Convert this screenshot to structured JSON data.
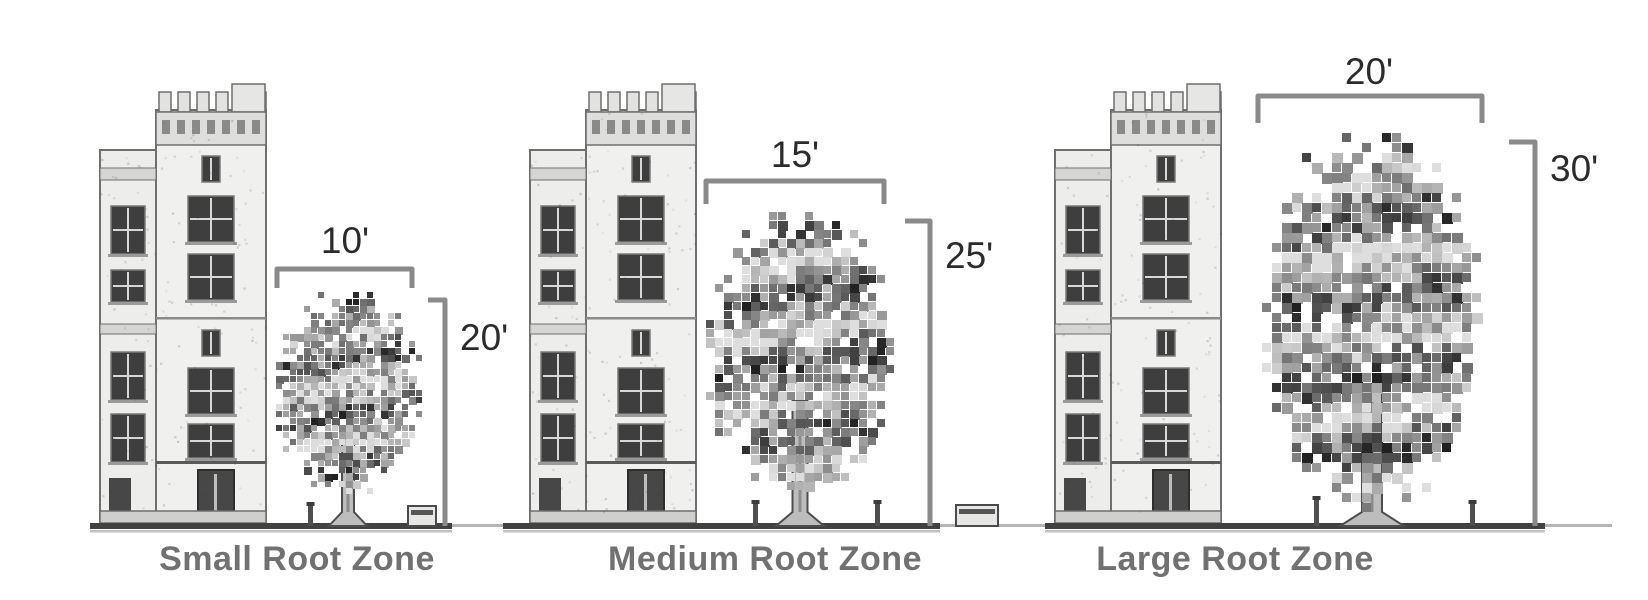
{
  "figure": {
    "description": "Tree root zone size comparison diagram",
    "panels": [
      {
        "id": "small",
        "caption": "Small Root Zone",
        "canopy_width_label": "10'",
        "tree_height_label": "20'",
        "canopy_width_ft": 10,
        "tree_height_ft": 20
      },
      {
        "id": "medium",
        "caption": "Medium Root Zone",
        "canopy_width_label": "15'",
        "tree_height_label": "25'",
        "canopy_width_ft": 15,
        "tree_height_ft": 25
      },
      {
        "id": "large",
        "caption": "Large Root Zone",
        "canopy_width_label": "20'",
        "tree_height_label": "30'",
        "canopy_width_ft": 20,
        "tree_height_ft": 30
      }
    ],
    "colors": {
      "background": "#ffffff",
      "dimension_line": "#8a8a8a",
      "measurement_text": "#2b2b2b",
      "caption_text": "#717171",
      "ground_line": "#414141",
      "ground_line_light": "#b5b5b5"
    }
  }
}
